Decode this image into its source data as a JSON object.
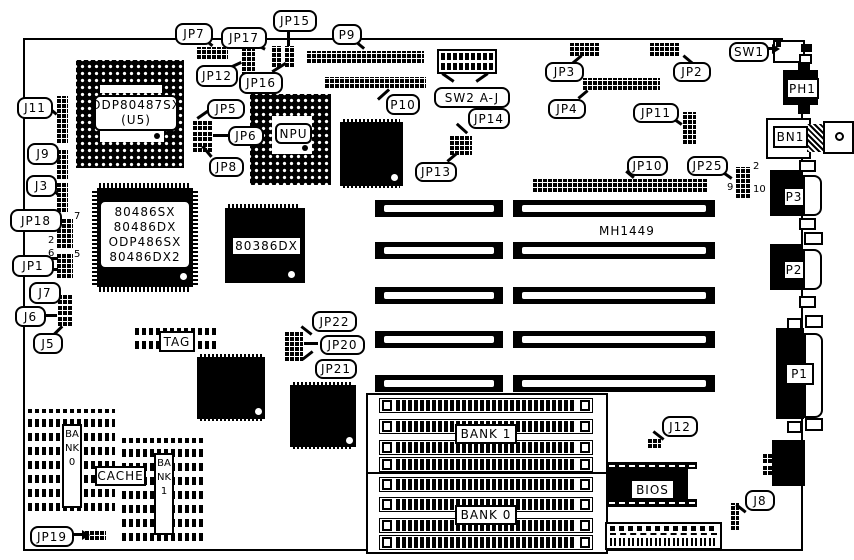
{
  "figure": {
    "description": "Motherboard jumper and connector location diagram"
  },
  "callouts": {
    "jp7": "JP7",
    "jp17": "JP17",
    "jp15": "JP15",
    "jp12": "JP12",
    "jp16": "JP16",
    "p9": "P9",
    "p10": "P10",
    "jp5": "JP5",
    "jp6": "JP6",
    "jp8": "JP8",
    "j11": "J11",
    "j9": "J9",
    "j3": "J3",
    "jp18": "JP18",
    "jp1": "JP1",
    "j7": "J7",
    "j6": "J6",
    "j5": "J5",
    "sw2": "SW2 A-J",
    "jp14": "JP14",
    "jp13": "JP13",
    "jp3": "JP3",
    "jp4": "JP4",
    "jp2": "JP2",
    "jp11": "JP11",
    "jp10": "JP10",
    "jp25": "JP25",
    "sw1": "SW1",
    "jp22": "JP22",
    "jp20": "JP20",
    "jp21": "JP21",
    "jp19": "JP19",
    "j12": "J12",
    "j8": "J8"
  },
  "chips": {
    "math_socket_line1": "ODP80487SX",
    "math_socket_line2": "(U5)",
    "cpu": [
      "80486SX",
      "80486DX",
      "ODP486SX",
      "80486DX2"
    ],
    "dx386": "80386DX",
    "npu": "NPU",
    "tag": "TAG",
    "cache": "CACHE",
    "cache_bank0": "BANK0",
    "cache_bank1": "BANK1",
    "bios": "BIOS",
    "board_marking": "MH1449"
  },
  "memory": {
    "bank1": "BANK 1",
    "bank0": "BANK 0"
  },
  "rear_connectors": {
    "ph1": "PH1",
    "bn1": "BN1",
    "p3": "P3",
    "p2": "P2",
    "p1": "P1"
  },
  "pin_numbers": {
    "jp18_pin8": "8",
    "jp18_pin7": "7",
    "jp18_pin2": "2",
    "jp1_pin6": "6",
    "jp1_pin5": "5",
    "jp1_pin2": "2",
    "jp25_pin2": "2",
    "jp25_pin9": "9",
    "jp25_pin10": "10"
  }
}
